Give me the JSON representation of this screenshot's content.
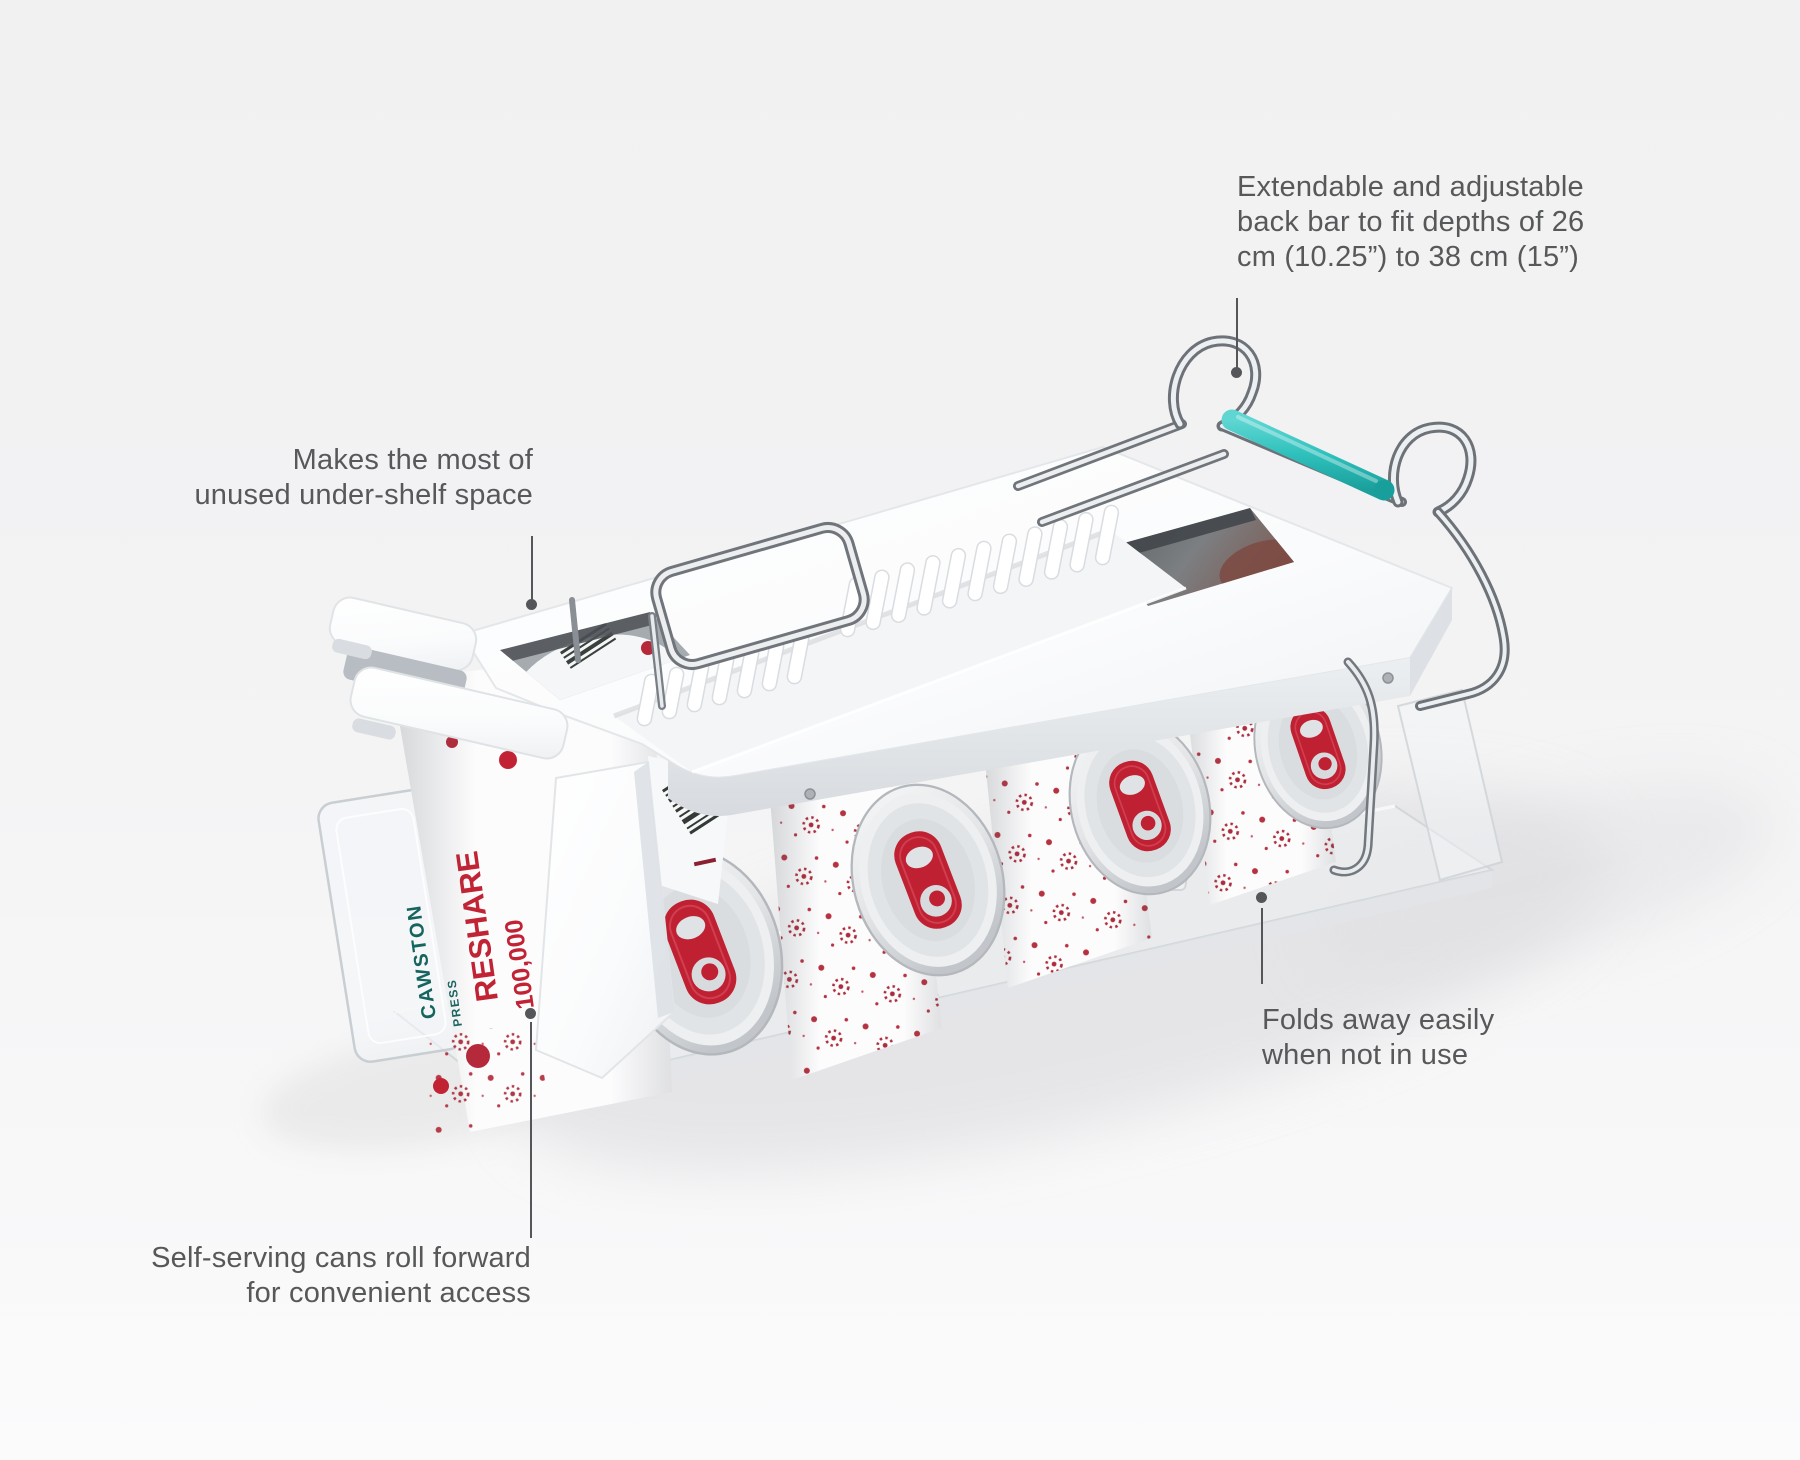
{
  "callouts": {
    "back_bar": {
      "lines": [
        "Extendable and adjustable",
        "back bar to fit depths of 26",
        "cm (10.25”) to 38 cm (15”)"
      ]
    },
    "under_shelf": {
      "lines": [
        "Makes the most of",
        "unused under-shelf space"
      ]
    },
    "folds_away": {
      "lines": [
        "Folds away easily",
        "when not in use"
      ]
    },
    "self_serving": {
      "lines": [
        "Self-serving cans roll forward",
        "for convenient access"
      ]
    }
  },
  "product": {
    "can_print": {
      "brand": "CAWSTON",
      "brand_sub": "PRESS",
      "word_reshare": "RESHARE",
      "word_number": "100,000"
    },
    "colors": {
      "accent_teal": "#2fc0bc",
      "tab_red": "#bf2133",
      "callout_text": "#57585a",
      "callout_line": "#55565a",
      "plastic_white": "#fdfdfe",
      "background": "#f3f3f4"
    }
  }
}
